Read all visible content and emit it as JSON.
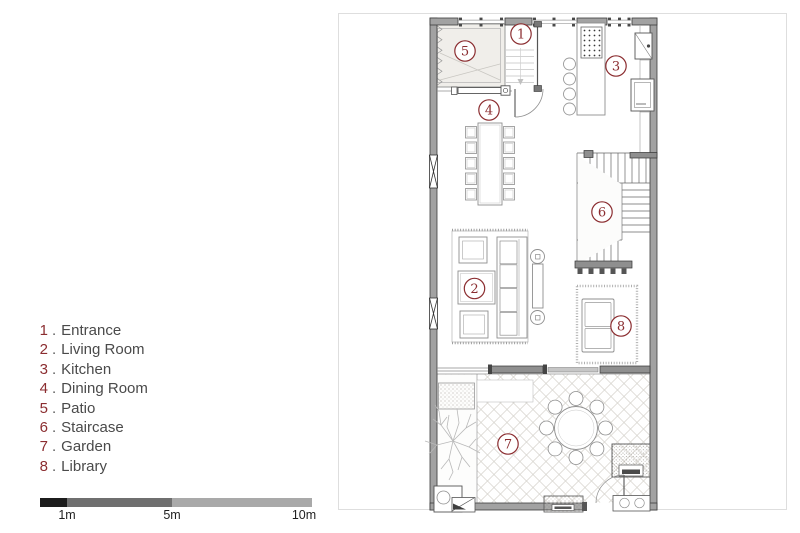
{
  "legend": {
    "separator": ".",
    "items": [
      {
        "number": "1",
        "name": "Entrance"
      },
      {
        "number": "2",
        "name": "Living Room"
      },
      {
        "number": "3",
        "name": "Kitchen"
      },
      {
        "number": "4",
        "name": "Dining Room"
      },
      {
        "number": "5",
        "name": "Patio"
      },
      {
        "number": "6",
        "name": "Staircase"
      },
      {
        "number": "7",
        "name": "Garden"
      },
      {
        "number": "8",
        "name": "Library"
      }
    ]
  },
  "scale_bar": {
    "labels": [
      "1m",
      "5m",
      "10m"
    ],
    "segment_colors": [
      "#1c1c1c",
      "#6f6f6f",
      "#a9a9a9"
    ]
  },
  "colors": {
    "accent_room_number": "#8b2d30",
    "legend_text": "#4a4a4a",
    "wall_gray": "#a2a2a2",
    "paving_hatch": "#d4d1cb"
  }
}
